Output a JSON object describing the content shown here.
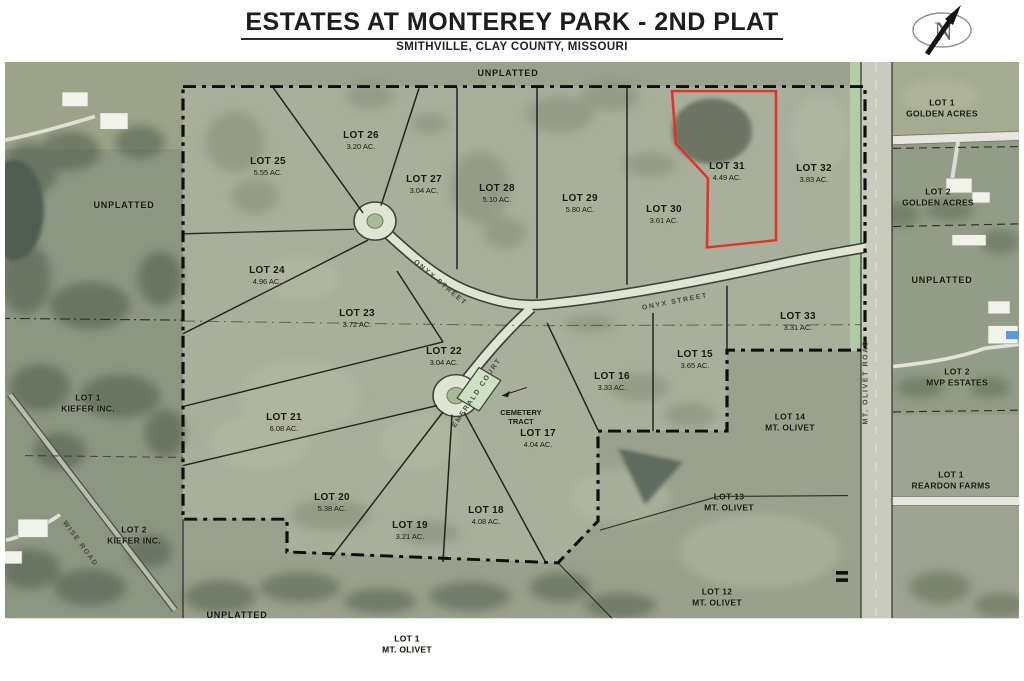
{
  "header": {
    "title": "ESTATES AT MONTEREY PARK - 2ND PLAT",
    "subtitle": "SMITHVILLE, CLAY COUNTY, MISSOURI"
  },
  "compass": {
    "letter": "N"
  },
  "colors": {
    "highlight_red": "#e0342a",
    "road_surface": "#dfe5d2",
    "road_verge_green": "#b3cba6",
    "aerial_base": "#9aa18c",
    "boundary_black": "#0e0f0c"
  },
  "plat_lots": [
    {
      "name": "LOT 25",
      "acreage": "5.55 AC.",
      "x": 268,
      "y": 166,
      "highlight": false
    },
    {
      "name": "LOT 26",
      "acreage": "3.20 AC.",
      "x": 361,
      "y": 140,
      "highlight": false
    },
    {
      "name": "LOT 27",
      "acreage": "3.04 AC.",
      "x": 424,
      "y": 184,
      "highlight": false
    },
    {
      "name": "LOT 28",
      "acreage": "5.10 AC.",
      "x": 497,
      "y": 193,
      "highlight": false
    },
    {
      "name": "LOT 29",
      "acreage": "5.80 AC.",
      "x": 580,
      "y": 203,
      "highlight": false
    },
    {
      "name": "LOT 30",
      "acreage": "3.61 AC.",
      "x": 664,
      "y": 214,
      "highlight": false
    },
    {
      "name": "LOT 31",
      "acreage": "4.49 AC.",
      "x": 727,
      "y": 171,
      "highlight": true
    },
    {
      "name": "LOT 32",
      "acreage": "3.83 AC.",
      "x": 814,
      "y": 173,
      "highlight": false
    },
    {
      "name": "LOT 24",
      "acreage": "4.96 AC.",
      "x": 267,
      "y": 275,
      "highlight": false
    },
    {
      "name": "LOT 23",
      "acreage": "3.72 AC.",
      "x": 357,
      "y": 318,
      "highlight": false
    },
    {
      "name": "LOT 22",
      "acreage": "3.04 AC.",
      "x": 444,
      "y": 356,
      "highlight": false
    },
    {
      "name": "LOT 33",
      "acreage": "3.31 AC.",
      "x": 798,
      "y": 321,
      "highlight": false
    },
    {
      "name": "LOT 15",
      "acreage": "3.65 AC.",
      "x": 695,
      "y": 359,
      "highlight": false
    },
    {
      "name": "LOT 16",
      "acreage": "3.33 AC.",
      "x": 612,
      "y": 381,
      "highlight": false
    },
    {
      "name": "LOT 21",
      "acreage": "6.08 AC.",
      "x": 284,
      "y": 422,
      "highlight": false
    },
    {
      "name": "LOT 17",
      "acreage": "4.04 AC.",
      "x": 538,
      "y": 438,
      "highlight": false
    },
    {
      "name": "LOT 20",
      "acreage": "5.38 AC.",
      "x": 332,
      "y": 502,
      "highlight": false
    },
    {
      "name": "LOT 19",
      "acreage": "3.21 AC.",
      "x": 410,
      "y": 530,
      "highlight": false
    },
    {
      "name": "LOT 18",
      "acreage": "4.08 AC.",
      "x": 486,
      "y": 515,
      "highlight": false
    }
  ],
  "neighbor_lots": [
    {
      "line1": "LOT 14",
      "line2": "MT. OLIVET",
      "x": 790,
      "y": 422
    },
    {
      "line1": "LOT 13",
      "line2": "MT. OLIVET",
      "x": 729,
      "y": 502
    },
    {
      "line1": "LOT 12",
      "line2": "MT. OLIVET",
      "x": 717,
      "y": 597
    },
    {
      "line1": "LOT 1",
      "line2": "GOLDEN ACRES",
      "x": 942,
      "y": 108
    },
    {
      "line1": "LOT 2",
      "line2": "GOLDEN ACRES",
      "x": 938,
      "y": 197
    },
    {
      "line1": "LOT 2",
      "line2": "MVP ESTATES",
      "x": 957,
      "y": 377
    },
    {
      "line1": "LOT 1",
      "line2": "REARDON FARMS",
      "x": 951,
      "y": 480
    },
    {
      "line1": "LOT 1",
      "line2": "KIEFER INC.",
      "x": 88,
      "y": 403
    },
    {
      "line1": "LOT 2",
      "line2": "KIEFER INC.",
      "x": 134,
      "y": 535
    },
    {
      "line1": "LOT 1",
      "line2": "MT. OLIVET",
      "x": 407,
      "y": 644
    }
  ],
  "unplatted_labels": [
    {
      "text": "UNPLATTED",
      "x": 508,
      "y": 74
    },
    {
      "text": "UNPLATTED",
      "x": 124,
      "y": 206
    },
    {
      "text": "UNPLATTED",
      "x": 942,
      "y": 281
    },
    {
      "text": "UNPLATTED",
      "x": 237,
      "y": 616
    }
  ],
  "street_labels": [
    {
      "name": "ONYX  STREET",
      "x": 440,
      "y": 283,
      "rot": 40
    },
    {
      "name": "ONYX  STREET",
      "x": 675,
      "y": 302,
      "rot": -11
    },
    {
      "name": "EMERALD  COURT",
      "x": 477,
      "y": 393,
      "rot": -56
    },
    {
      "name": "MT. OLIVET  ROAD",
      "x": 866,
      "y": 382,
      "rot": -90
    },
    {
      "name": "WISE  ROAD",
      "x": 80,
      "y": 544,
      "rot": 54
    }
  ],
  "cemetery": {
    "line1": "CEMETERY",
    "line2": "TRACT",
    "x": 521,
    "y": 417
  }
}
